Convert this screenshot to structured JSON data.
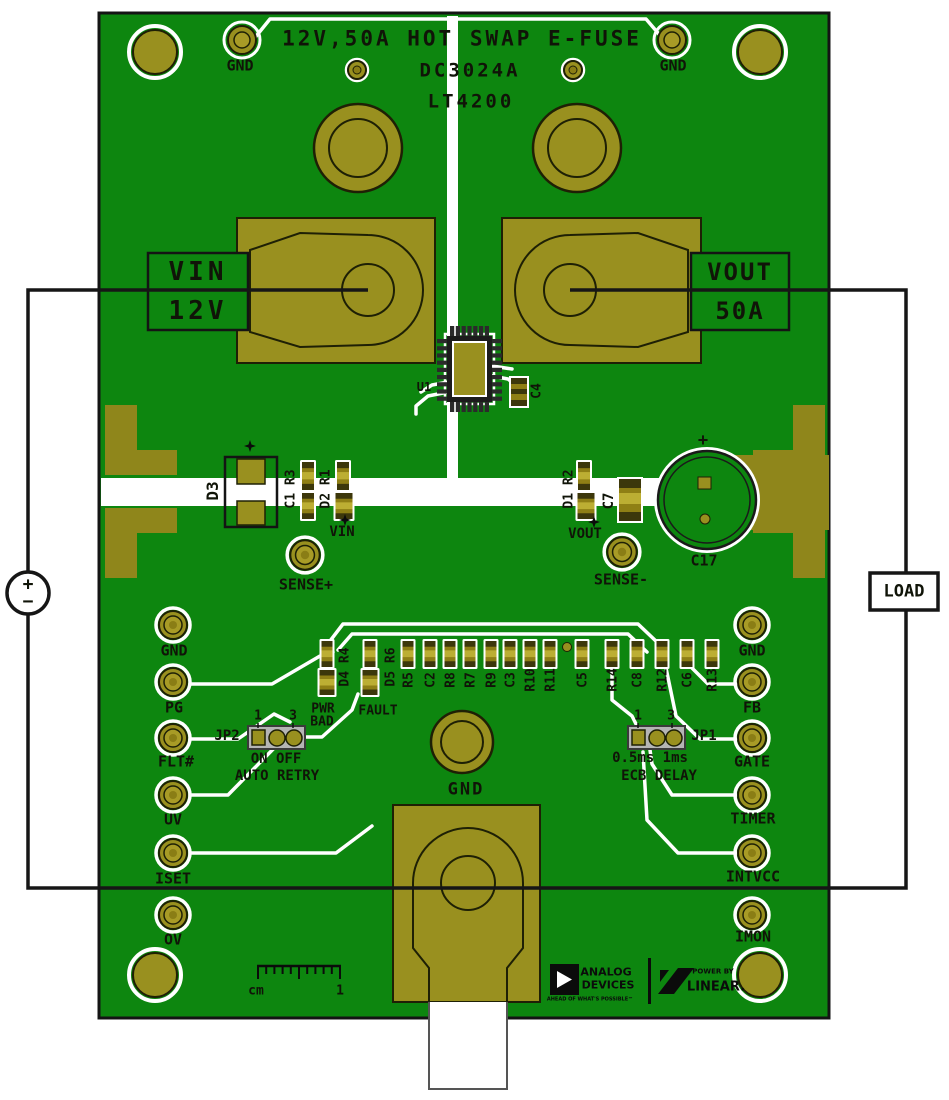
{
  "board_title": {
    "line1": "12V,50A HOT SWAP E-FUSE",
    "line2": "DC3024A",
    "line3": "LT4200"
  },
  "top": {
    "gnd_left": "GND",
    "gnd_right": "GND"
  },
  "io": {
    "vin": "VIN",
    "vin_value": "12V",
    "vout": "VOUT",
    "vout_value": "50A"
  },
  "external": {
    "load": "LOAD",
    "source_plus": "+",
    "source_minus": "−"
  },
  "mid": {
    "u1": "U1",
    "c4": "C4",
    "d3": "D3",
    "c1_r3": "C1 R3",
    "d2_r1": "D2 R1",
    "vin_net": "VIN",
    "sense_plus": "SENSE+",
    "d1_r2": "D1 R2",
    "vout_net": "VOUT",
    "c7": "C7",
    "c17": "C17",
    "c17_plus": "+",
    "sense_minus": "SENSE-"
  },
  "left_pins": [
    "GND",
    "PG",
    "FLT#",
    "UV",
    "ISET",
    "OV"
  ],
  "right_pins": [
    "GND",
    "FB",
    "GATE",
    "TIMER",
    "INTVCC",
    "IMON"
  ],
  "jp2": {
    "name": "JP2",
    "pin1": "1",
    "pin3": "3",
    "line1": "ON OFF",
    "line2": "AUTO RETRY"
  },
  "jp1": {
    "name": "JP1",
    "pin1": "1",
    "pin3": "3",
    "line1": "0.5ms 1ms",
    "line2": "ECB DELAY"
  },
  "status": {
    "pwr": "PWR",
    "bad": "BAD",
    "fault": "FAULT"
  },
  "smd_row": [
    "D4 R4",
    "D5 R6",
    "R5",
    "C2",
    "R8",
    "R7",
    "R9",
    "C3",
    "R10",
    "R11",
    "C5",
    "R14",
    "C8",
    "R12",
    "C6",
    "R13"
  ],
  "bottom": {
    "gnd": "GND"
  },
  "ruler": {
    "unit": "cm",
    "mark": "1"
  },
  "logos": {
    "adi_top": "ANALOG",
    "adi_bottom": "DEVICES",
    "adi_tagline": "AHEAD OF WHAT'S POSSIBLE™",
    "lt_top": "POWER BY",
    "lt_bottom": "LINEAR."
  },
  "colors": {
    "board_green": "#0d860f",
    "copper_gold": "#99901f",
    "silkscreen": "#ffffff",
    "wire_black": "#161616"
  }
}
